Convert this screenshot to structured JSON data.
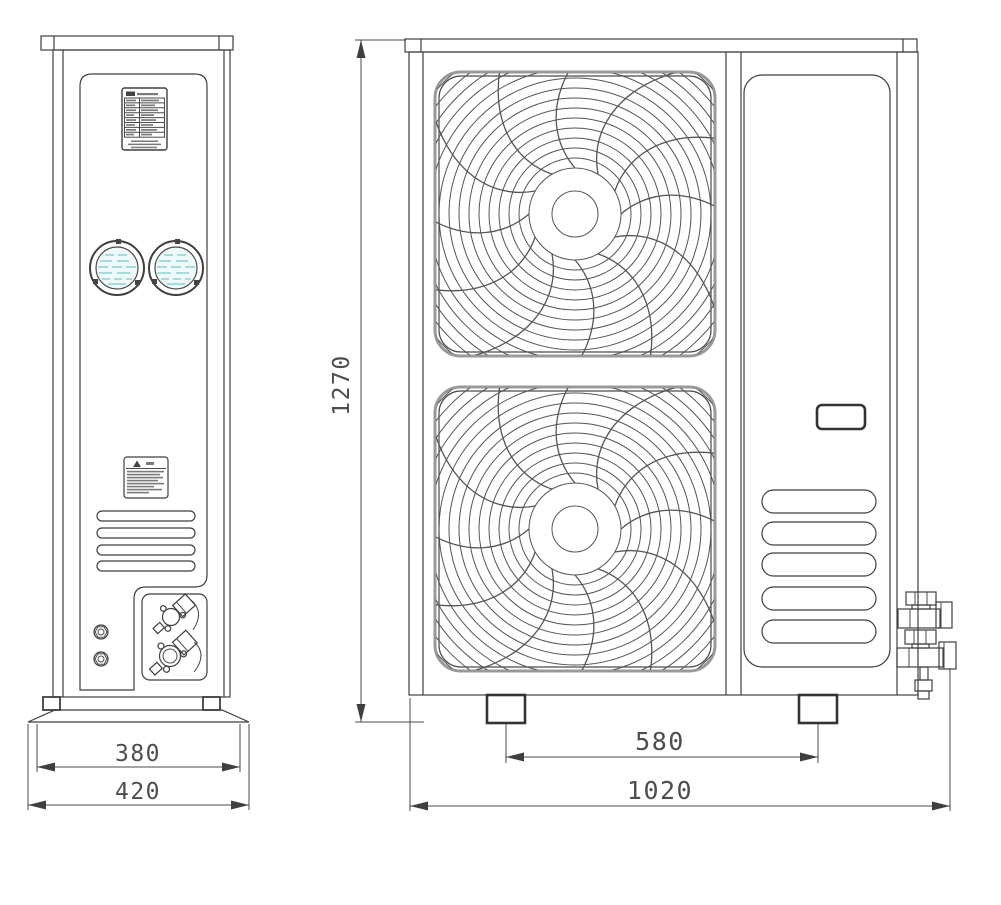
{
  "diagram": {
    "side_view": {
      "dim_inner_width": "380",
      "dim_outer_width": "420"
    },
    "front_view": {
      "dim_height": "1270",
      "dim_foot_spacing": "580",
      "dim_overall_width": "1020"
    },
    "colors": {
      "line": "#3f3f3f",
      "dimension_text": "#4d4d4d",
      "sight_glass_teal": "#8ed1d4",
      "sight_glass_fill": "#f0f9f9",
      "background": "#ffffff"
    }
  }
}
